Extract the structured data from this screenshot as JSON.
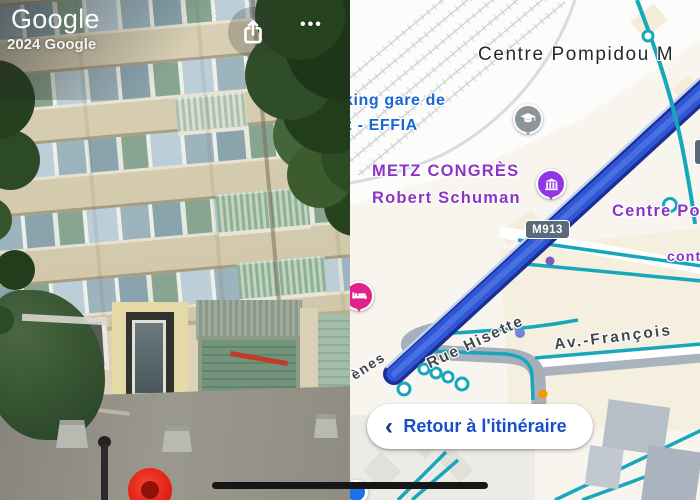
{
  "street_view": {
    "watermark_logo": "Google",
    "watermark_copyright": "2024 Google",
    "share_icon": "ios-share-icon",
    "more_icon_dots": "•••"
  },
  "map": {
    "poi_labels": {
      "pompidou_top": "Centre Pompidou M",
      "parking_line1": "king gare de",
      "parking_line2": "z - EFFIA",
      "congress_line1": "METZ CONGRÈS",
      "congress_line2": "Robert Schuman",
      "pompidou_right": "Centre Po",
      "partial_right": "conte"
    },
    "street_labels": {
      "avenue": "Av.-François",
      "rue_hisette": "Rue Hisette",
      "partial_arenes": "ènes"
    },
    "road_badge": "M913",
    "back_button": {
      "chevron": "‹",
      "label": "Retour à l'itinéraire"
    },
    "icons": {
      "hotel_pin": "bed-icon",
      "education_pin": "graduation-cap-icon",
      "venue_pin": "building-icon",
      "location": "blue-location-dot"
    },
    "colors": {
      "route_fill": "#2e57d6",
      "route_casing": "#1b2f92",
      "transit_teal": "#17a7bd",
      "poi_blue": "#1967d2",
      "poi_purple": "#8c35c4",
      "street_label": "#41474d",
      "button_text": "#1a4fc9",
      "hotel_pink": "#e0218a",
      "badge_bg": "#5a6a79",
      "location_blue": "#1a73e8",
      "marker_red": "#e01708"
    }
  }
}
